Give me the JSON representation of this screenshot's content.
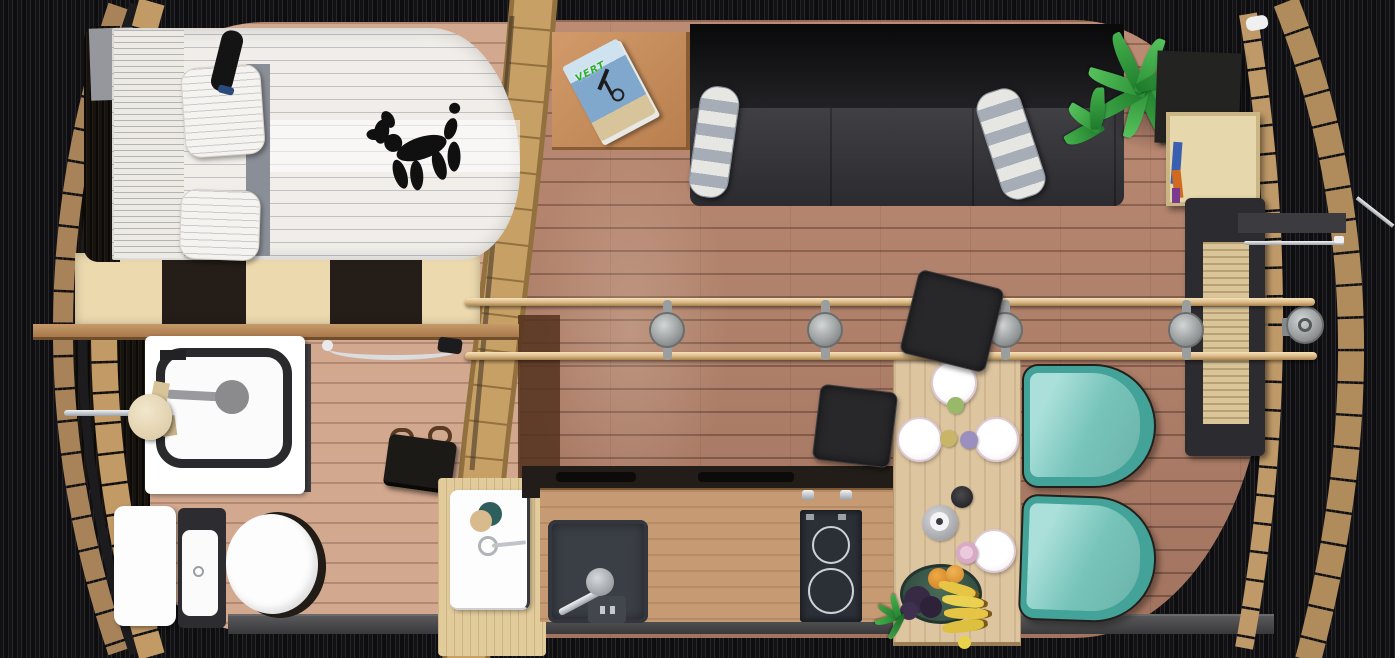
{
  "scene": {
    "name": "Barrel tiny house - top-down floor plan rendering",
    "style": "3D rendered plan view inside a wooden barrel shell on a dark slatted background"
  },
  "magazine": {
    "title": "VERT",
    "cover": "mountain-bike rider"
  },
  "palette": {
    "background_dark": "#1c1c1e",
    "barrel_wood": "#c29a66",
    "floor_living": "#b4816a",
    "floor_bathroom": "#d2a88f",
    "divider_light": "#ecd9ae",
    "divider_dark": "#241d18",
    "sofa_charcoal": "#35353a",
    "chair_teal": "#7ed0c6",
    "bed_linen": "#f1eeea",
    "counter_wood": "#c69b74",
    "appliance_dark": "#2b2f36",
    "accent_plant": "#44b04b"
  },
  "rooms": {
    "bedroom": {
      "label": "Sleeping area",
      "items": [
        "double bed with striped linen",
        "two striped pillows",
        "black wall reading lamp",
        "black balloon-dog figurine",
        "checkered headboard storage divider"
      ]
    },
    "bathroom": {
      "label": "Bathroom",
      "items": [
        "shower with dark frame and drain",
        "toilet with dark cistern",
        "white washbasin with cup and toothbrush",
        "chrome towel rails",
        "towel roll"
      ]
    },
    "living": {
      "label": "Lounge",
      "items": [
        "charcoal sofa",
        "two striped bolster cushions",
        "side table with magazine",
        "potted palm plant",
        "dark wall cabinet",
        "plywood box shelf with books",
        "slatted desk"
      ]
    },
    "dining": {
      "label": "Dining corner",
      "items": [
        "wooden table",
        "4 white plates",
        "colored cups",
        "metal kettle",
        "fruit bowl with bananas, grapes and oranges",
        "2 teal tub chairs",
        "2 dark stools"
      ]
    },
    "kitchen": {
      "label": "Kitchenette",
      "items": [
        "wood counter",
        "square sink with faucet",
        "two-burner cooktop",
        "dark serving tray with handles"
      ]
    },
    "structure": {
      "label": "Barrel shell",
      "items": [
        "left barrel rim arcs",
        "right barrel rim arcs",
        "centre rib band",
        "two tie rods with four turnbuckles",
        "metal wall lamp",
        "grey plinth"
      ]
    }
  },
  "counts": {
    "plates": 4,
    "teal_chairs": 2,
    "stools": 2,
    "turnbuckles": 4,
    "tie_rods": 2
  }
}
